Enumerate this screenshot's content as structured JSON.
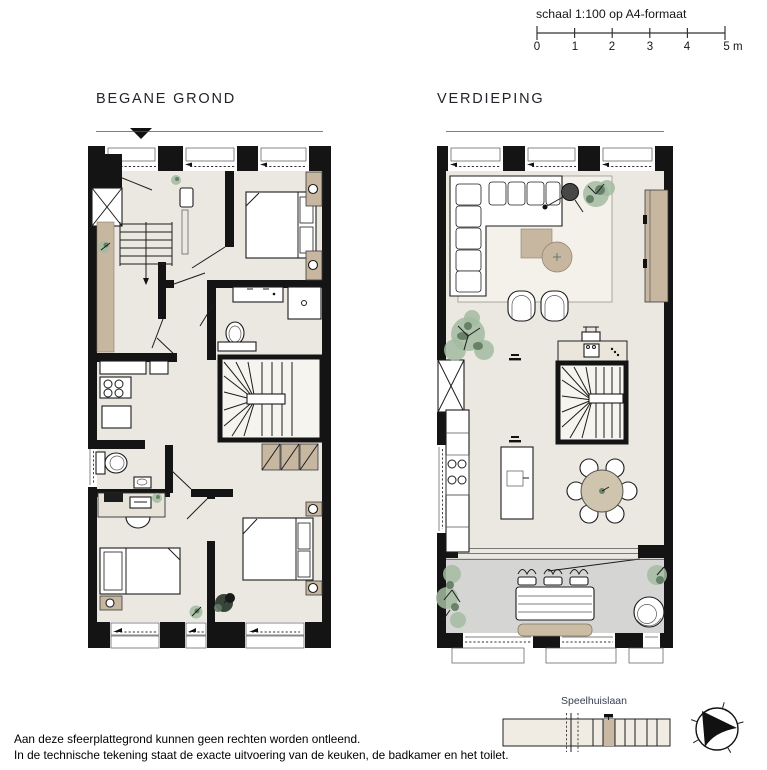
{
  "header": {
    "scale_label": "schaal 1:100 op A4-formaat",
    "scale_ticks": [
      "0",
      "1",
      "2",
      "3",
      "4",
      "5 m"
    ]
  },
  "plans": [
    {
      "title": "BEGANE GROND"
    },
    {
      "title": "VERDIEPING"
    }
  ],
  "site_diagram": {
    "street_label": "Speelhuislaan",
    "building_label": "Kantoren"
  },
  "footnotes": [
    "Aan deze sfeerplattegrond kunnen geen rechten worden ontleend.",
    "In de technische tekening staat de exacte uitvoering van de keuken, de badkamer en het toilet."
  ],
  "colors": {
    "wall": "#141414",
    "floor": "#ebe8e1",
    "accent_tan": "#c7b7a0",
    "balcony_gray": "#d5d5d3",
    "plant_green": "#a3bba1",
    "site_highlight": "#c9b9a3"
  }
}
